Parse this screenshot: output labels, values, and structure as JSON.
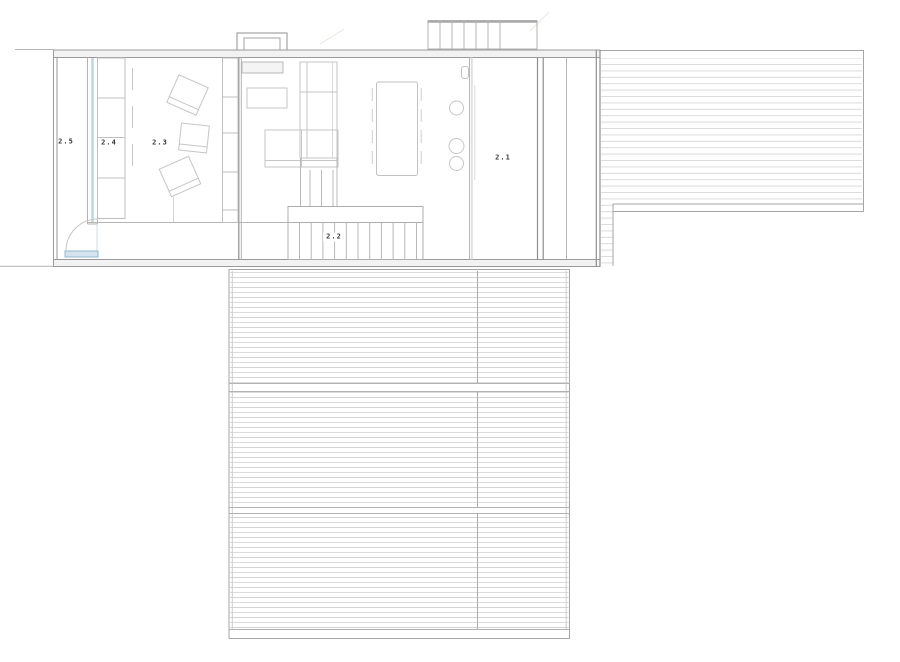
{
  "drawing": {
    "type": "architectural-floor-plan",
    "level": "upper-floor-plan"
  },
  "rooms": [
    {
      "label": "2.5"
    },
    {
      "label": "2.4"
    },
    {
      "label": "2.3"
    },
    {
      "label": "2.2"
    },
    {
      "label": "2.1"
    }
  ],
  "colors": {
    "paper": "#ffffff",
    "wall": "#9a9a9a",
    "partition": "#8e8e8e",
    "line": "#b3b3b3",
    "furn": "#c6c6c6",
    "hatch": "#d8d8d8",
    "hatch2": "#cfcfcf",
    "deckborder": "#a6a6a6",
    "glazing": "#b7d6e4",
    "doorfill": "#d3e4ee",
    "doorstroke": "#93b9cd",
    "label": "#333333"
  }
}
